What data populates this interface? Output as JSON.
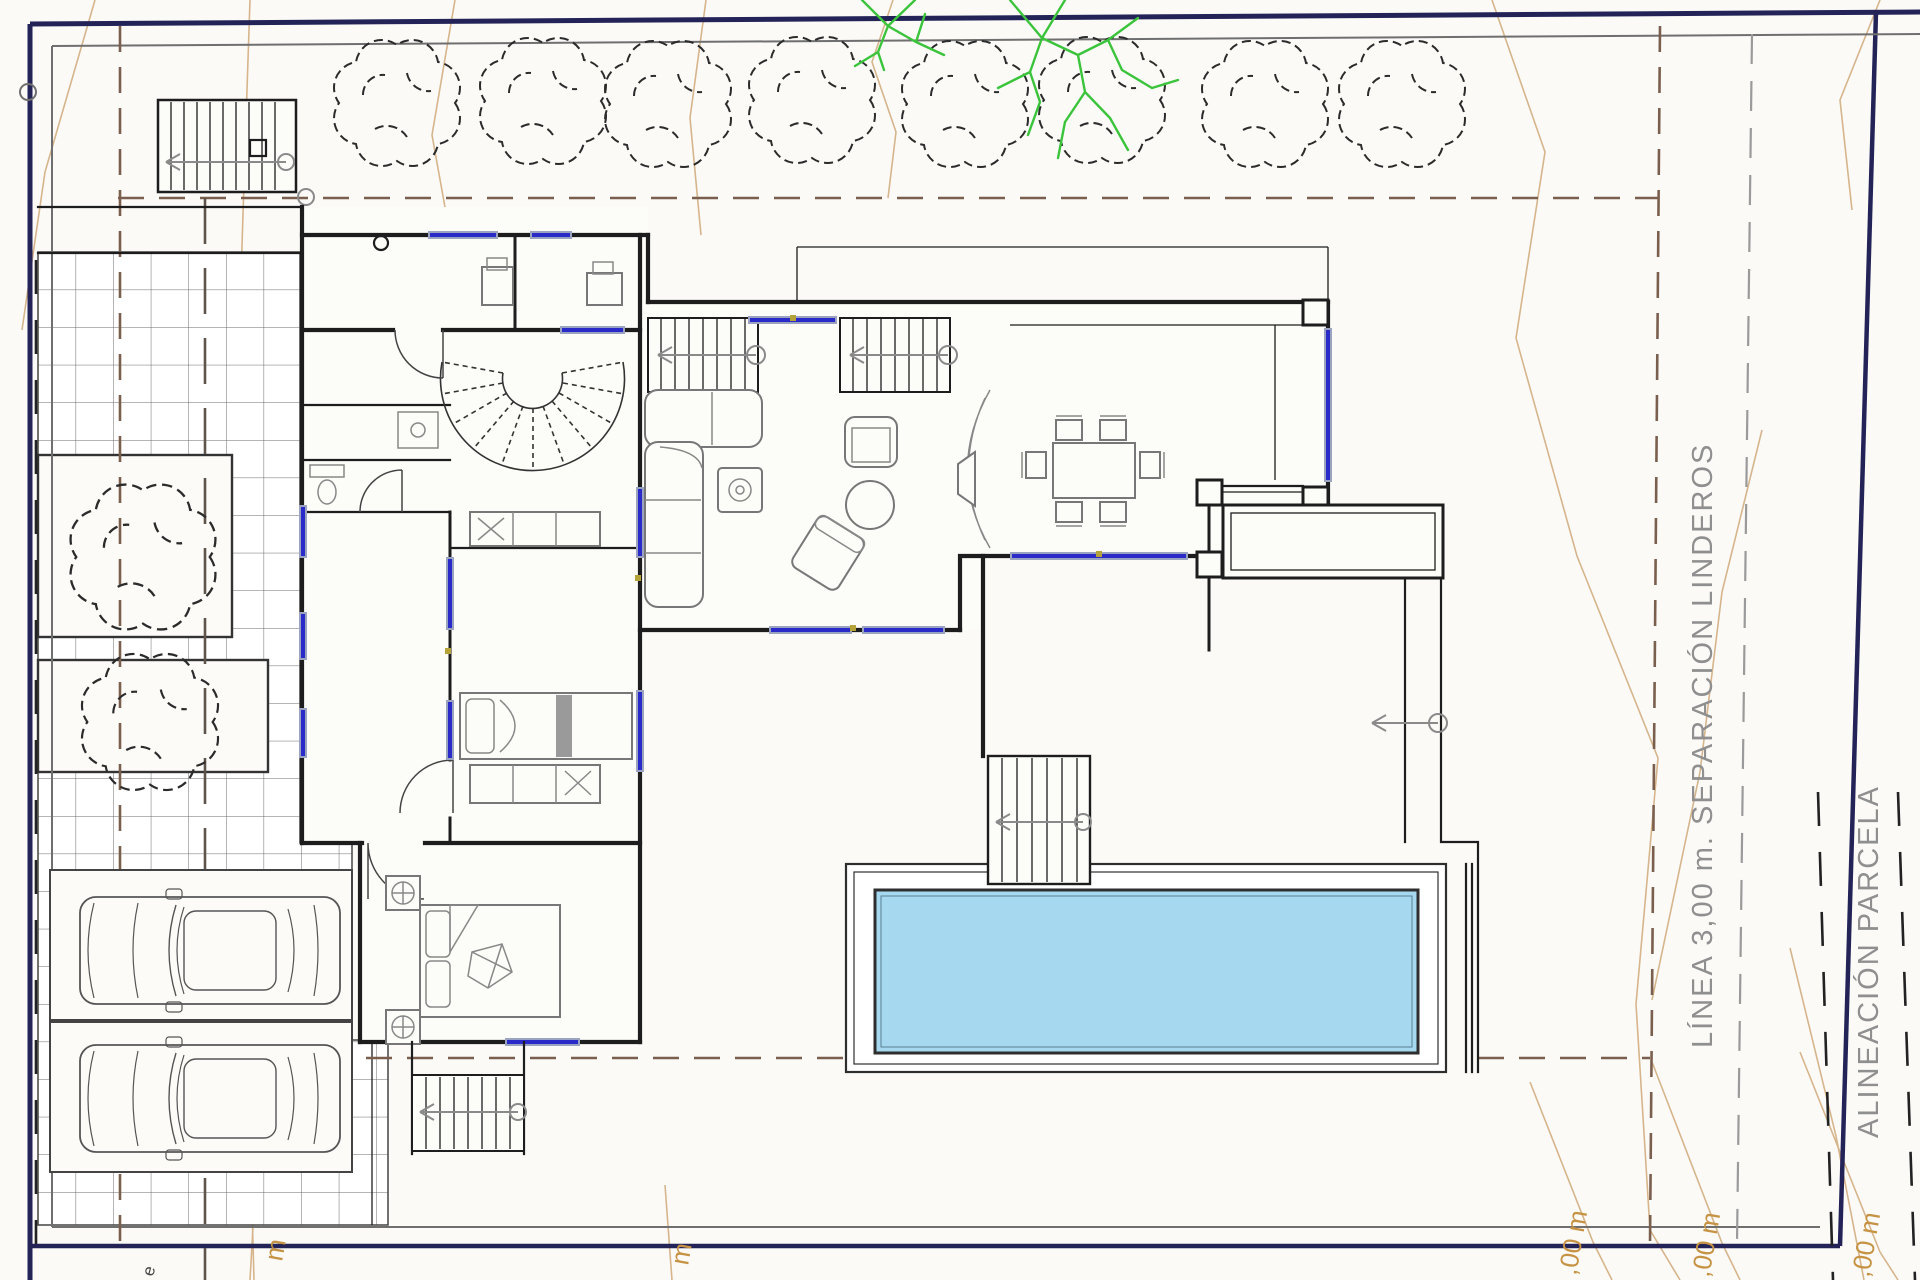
{
  "page": {
    "width": 1920,
    "height": 1280,
    "background": "#fbfaf7"
  },
  "plan": {
    "type": "architectural-site-plan-villa-ground-floor",
    "labels": {
      "separation_line": "LÍNEA 3,00 m. SEPARACIÓN LINDEROS",
      "parcel_alignment": "ALINEACIÓN PARCELA",
      "contour_label_a": ",00 m",
      "contour_label_b": ",00 m",
      "contour_label_c": ",00 m",
      "contour_fragment_a": "m",
      "contour_fragment_b": "m",
      "contour_fragment_c": "e"
    },
    "colors": {
      "parcel_boundary_navy": "#232358",
      "inner_boundary_gray": "#6f6f6f",
      "setback_dash_brown": "#7b5f4e",
      "setback_dash_dark": "#5e544b",
      "survey_dash_black": "#222222",
      "contour_line_orange": "#d6b58c",
      "contour_label_orange": "#c69344",
      "wall_black": "#1d1d1d",
      "window_blue": "#2a2ac8",
      "window_gray": "#9aa3c0",
      "pool_water_blue": "#a6d9f0",
      "tree_outline": "#2b2b2b",
      "green_tree": "#3bc43b",
      "tile_line_gray": "#6a6a6a",
      "annotation_gray": "#8f8f8f",
      "accent_olive": "#b3a339"
    },
    "inventory": {
      "trees_top_row": 8,
      "trees_left_side": 2,
      "green_branch_trees": 2,
      "cars_parked": 2,
      "staircases": 6,
      "swimming_pools": 1,
      "dining_seats": 6,
      "beds": 2
    }
  }
}
